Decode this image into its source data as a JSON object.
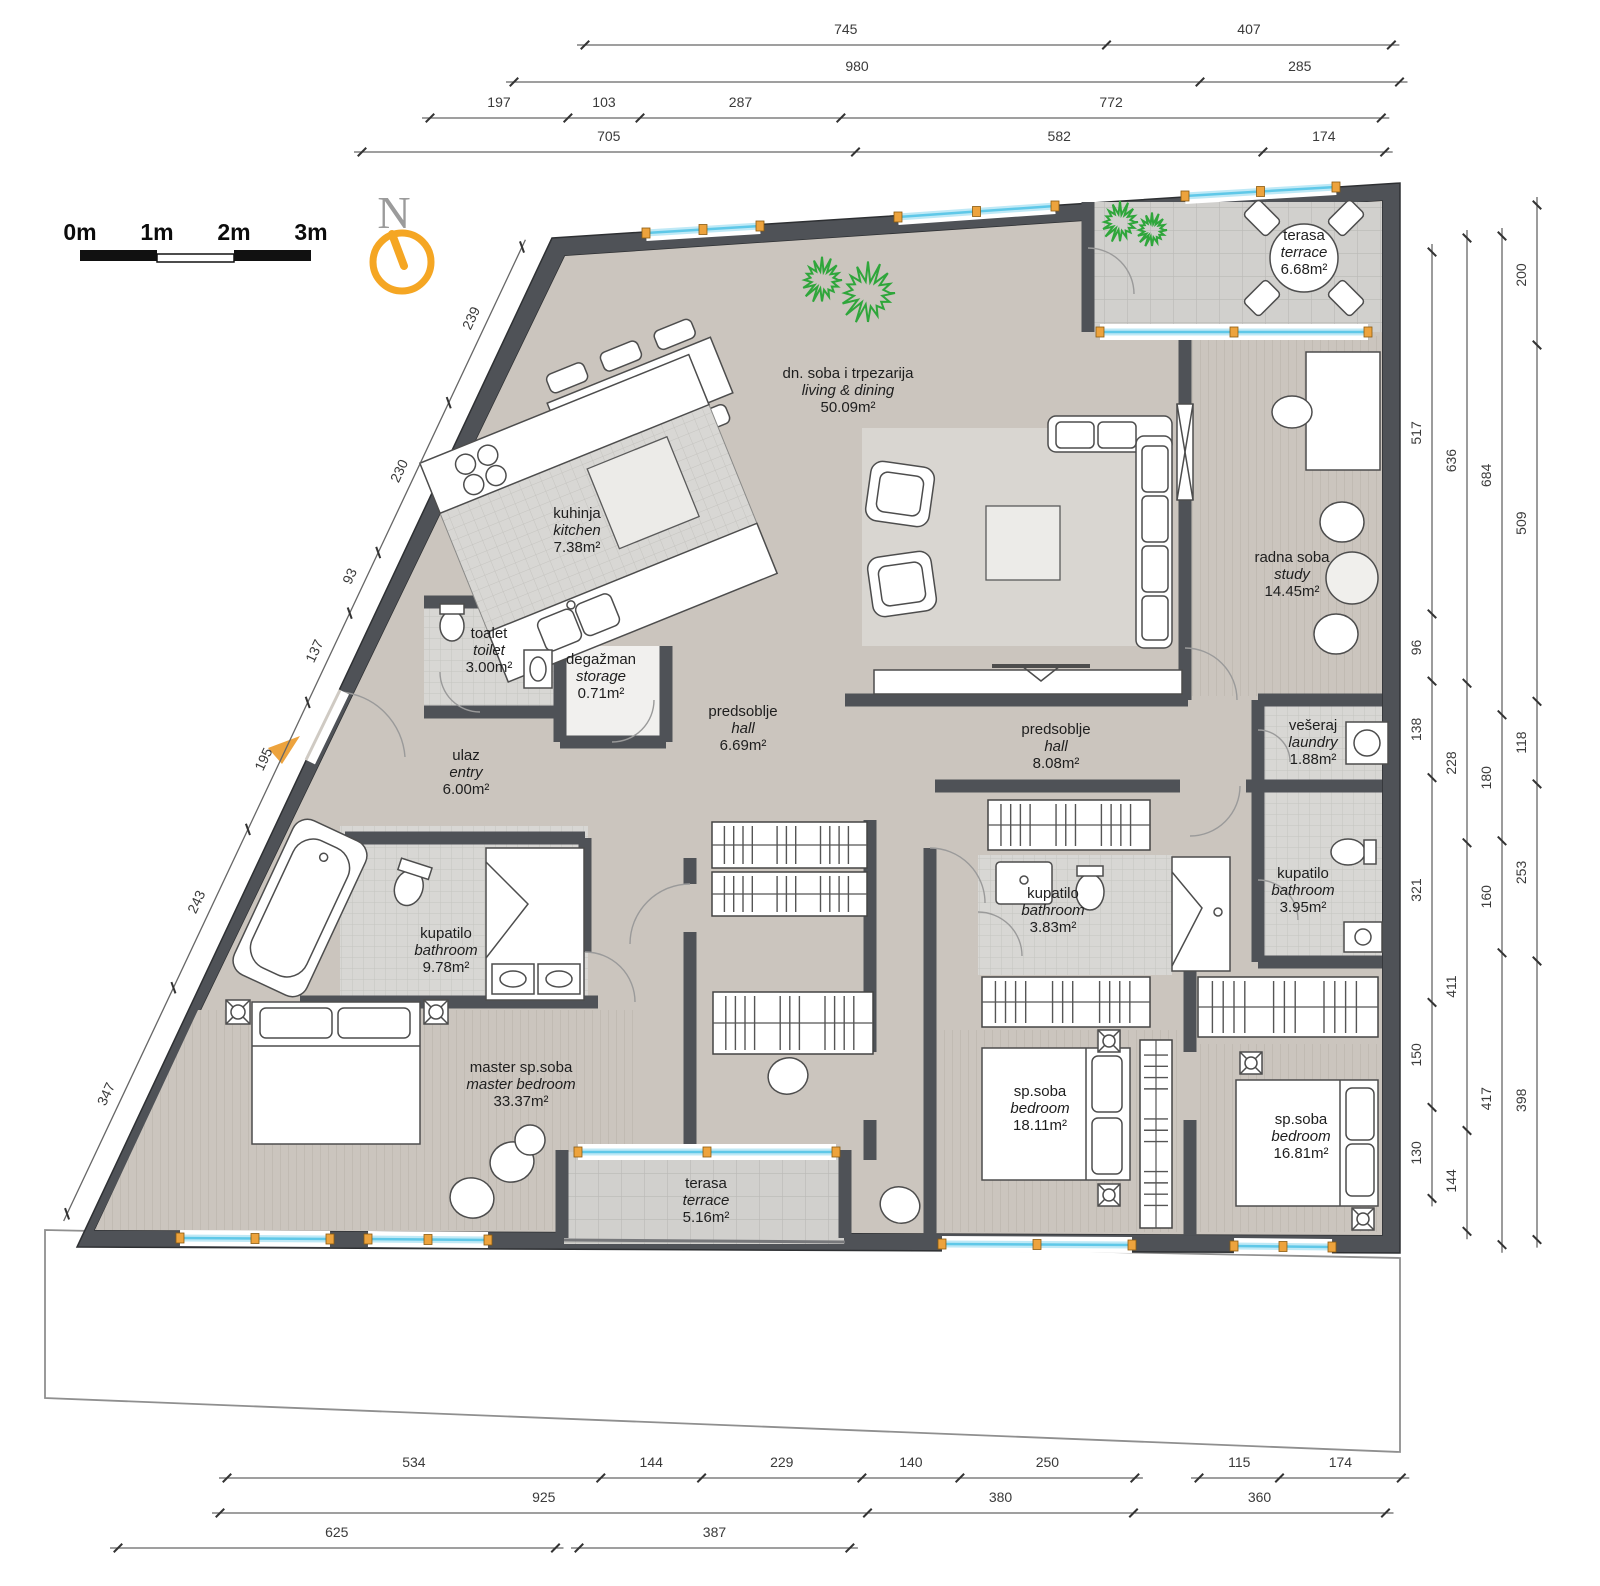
{
  "plan": {
    "title": "apartment floor plan",
    "scale_bar": {
      "labels": [
        "0m",
        "1m",
        "2m",
        "3m"
      ]
    },
    "north_label": "N",
    "rooms": [
      {
        "id": "living",
        "name": "dn. soba i trpezarija",
        "name_en": "living & dining",
        "area": "50.09m²"
      },
      {
        "id": "kitchen",
        "name": "kuhinja",
        "name_en": "kitchen",
        "area": "7.38m²"
      },
      {
        "id": "toilet",
        "name": "toalet",
        "name_en": "toilet",
        "area": "3.00m²"
      },
      {
        "id": "storage",
        "name": "degažman",
        "name_en": "storage",
        "area": "0.71m²"
      },
      {
        "id": "entry",
        "name": "ulaz",
        "name_en": "entry",
        "area": "6.00m²"
      },
      {
        "id": "hall_west",
        "name": "predsoblje",
        "name_en": "hall",
        "area": "6.69m²"
      },
      {
        "id": "hall_east",
        "name": "predsoblje",
        "name_en": "hall",
        "area": "8.08m²"
      },
      {
        "id": "study",
        "name": "radna soba",
        "name_en": "study",
        "area": "14.45m²"
      },
      {
        "id": "terrace_top",
        "name": "terasa",
        "name_en": "terrace",
        "area": "6.68m²"
      },
      {
        "id": "laundry",
        "name": "vešeraj",
        "name_en": "laundry",
        "area": "1.88m²"
      },
      {
        "id": "bath_right",
        "name": "kupatilo",
        "name_en": "bathroom",
        "area": "3.95m²"
      },
      {
        "id": "bath_mid",
        "name": "kupatilo",
        "name_en": "bathroom",
        "area": "3.83m²"
      },
      {
        "id": "bath_master",
        "name": "kupatilo",
        "name_en": "bathroom",
        "area": "9.78m²"
      },
      {
        "id": "master_bedroom",
        "name": "master sp.soba",
        "name_en": "master bedroom",
        "area": "33.37m²"
      },
      {
        "id": "bedroom_18",
        "name": "sp.soba",
        "name_en": "bedroom",
        "area": "18.11m²"
      },
      {
        "id": "bedroom_16",
        "name": "sp.soba",
        "name_en": "bedroom",
        "area": "16.81m²"
      },
      {
        "id": "terrace_bottom",
        "name": "terasa",
        "name_en": "terrace",
        "area": "5.16m²"
      }
    ],
    "dimensions": {
      "top": [
        [
          "745",
          "407"
        ],
        [
          "980",
          "285"
        ],
        [
          "197",
          "103",
          "287",
          "772"
        ],
        [
          "705",
          "582",
          "174"
        ]
      ],
      "bottom": [
        [
          "534",
          "144",
          "229",
          "140",
          "250"
        ],
        [
          "115",
          "174"
        ],
        [
          "925",
          "380",
          "360"
        ],
        [
          "625"
        ],
        [
          "387"
        ]
      ],
      "left": [
        "239",
        "230",
        "93",
        "137",
        "195",
        "243",
        "347"
      ],
      "right": [
        [
          "517",
          "96",
          "138",
          "321",
          "150",
          "130"
        ],
        [
          "636",
          "228",
          "411",
          "144"
        ],
        [
          "684",
          "180",
          "160",
          "417"
        ],
        [
          "200",
          "509",
          "118",
          "253",
          "398"
        ]
      ]
    },
    "colors": {
      "wall": "#4f5257",
      "floor": "#cbc5be",
      "tile": "#d8d7d4",
      "terrace_tile": "#d1d0cd",
      "window": "#6fcde8",
      "accent_orange": "#eda33d",
      "plant_green": "#2fa63b"
    }
  }
}
